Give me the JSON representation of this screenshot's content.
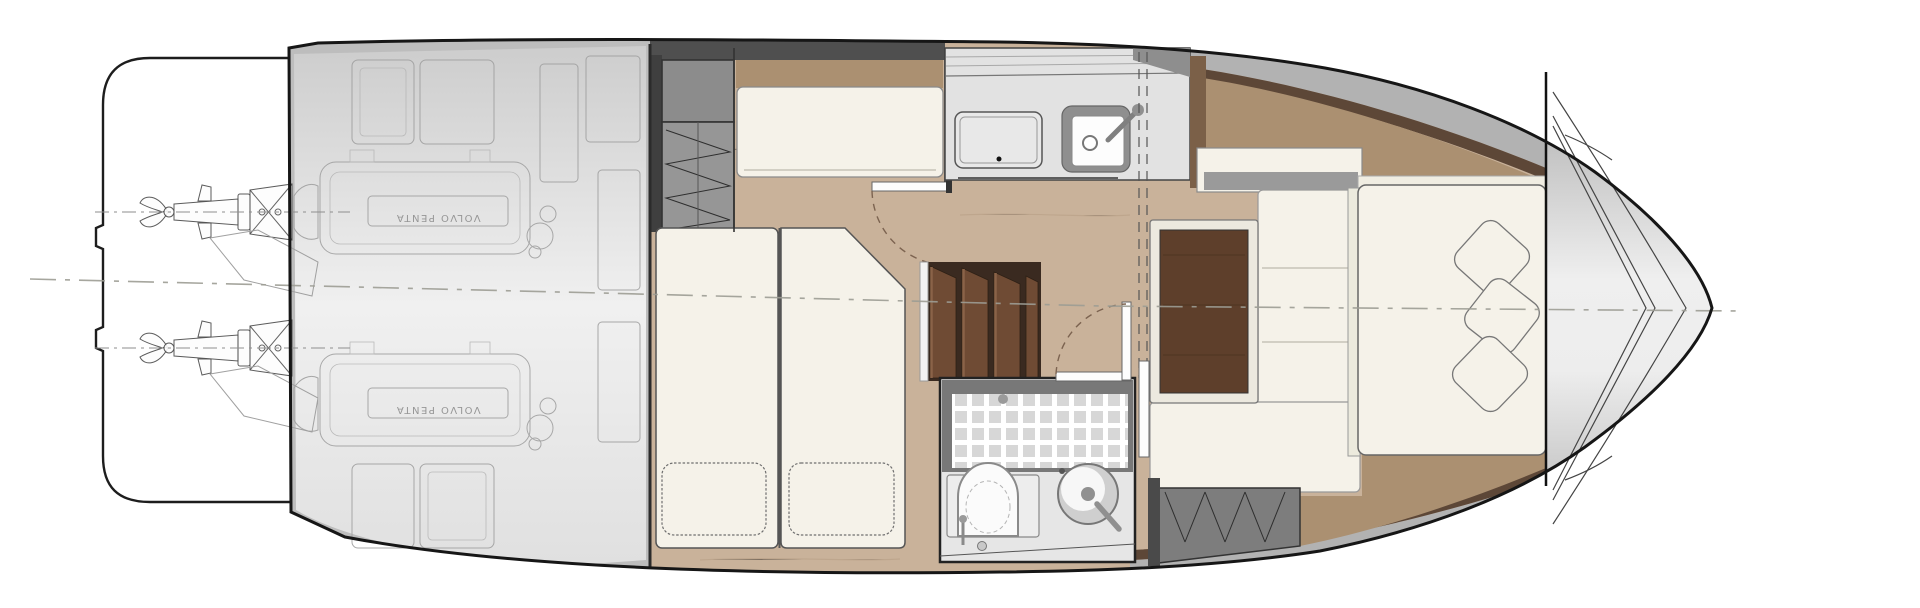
{
  "meta": {
    "drawing_title": "Motor yacht lower deck floor plan",
    "view": "overhead plan view",
    "orientation": "bow to the right, stern with swim platform to the left"
  },
  "engine_room": {
    "engine_label": "VOLVO PENTA",
    "engine_count": 2,
    "sterndrive_count": 2
  },
  "rooms": {
    "stern": [
      "swim-platform",
      "engine-room"
    ],
    "midship": [
      "twin-berth-guest-cabin",
      "companionway-stairs",
      "galley",
      "head"
    ],
    "bow": [
      "master-cabin",
      "bow-locker"
    ]
  },
  "fixtures": {
    "galley": [
      "cooktop",
      "sink-with-faucet"
    ],
    "head": [
      "tiled-shower",
      "toilet",
      "round-washbasin"
    ],
    "guest_cabin": [
      "hanging-locker",
      "cabinet",
      "settee",
      "twin-beds"
    ],
    "master_cabin": [
      "l-shaped-sofa",
      "wood-table",
      "double-bed",
      "wardrobe"
    ],
    "twin_bed_pillows": 2,
    "master_bed_pillows": 3
  },
  "palette": {
    "hull_outline": "#161616",
    "deck_gray": "#bdbdbd",
    "engine_room_light": "#ececec",
    "wood_floor": "#c9b29a",
    "wood_shelf": "#ab9071",
    "wood_trim_dark": "#5d4737",
    "galley_brown": "#7b6048",
    "furniture_white": "#f5f2e9",
    "counter_gray": "#e2e2e2",
    "sink_gray": "#8f8f8f",
    "wardrobe_gray": "#969696",
    "wardrobe2_gray": "#7d7d7d",
    "cabinet_gray": "#8c8c8c",
    "dark_band": "#4f4f4f",
    "stair_dark": "#3a2a20",
    "stair_wood": "#6f4b34",
    "table_wood": "#5e3f2b",
    "tile_gray": "#d7d7d7",
    "shower_frame": "#787878",
    "bathroom_floor": "#e6e6e6",
    "centerline_gray": "#9c9c94",
    "door_arc_brown": "#7c6350"
  }
}
